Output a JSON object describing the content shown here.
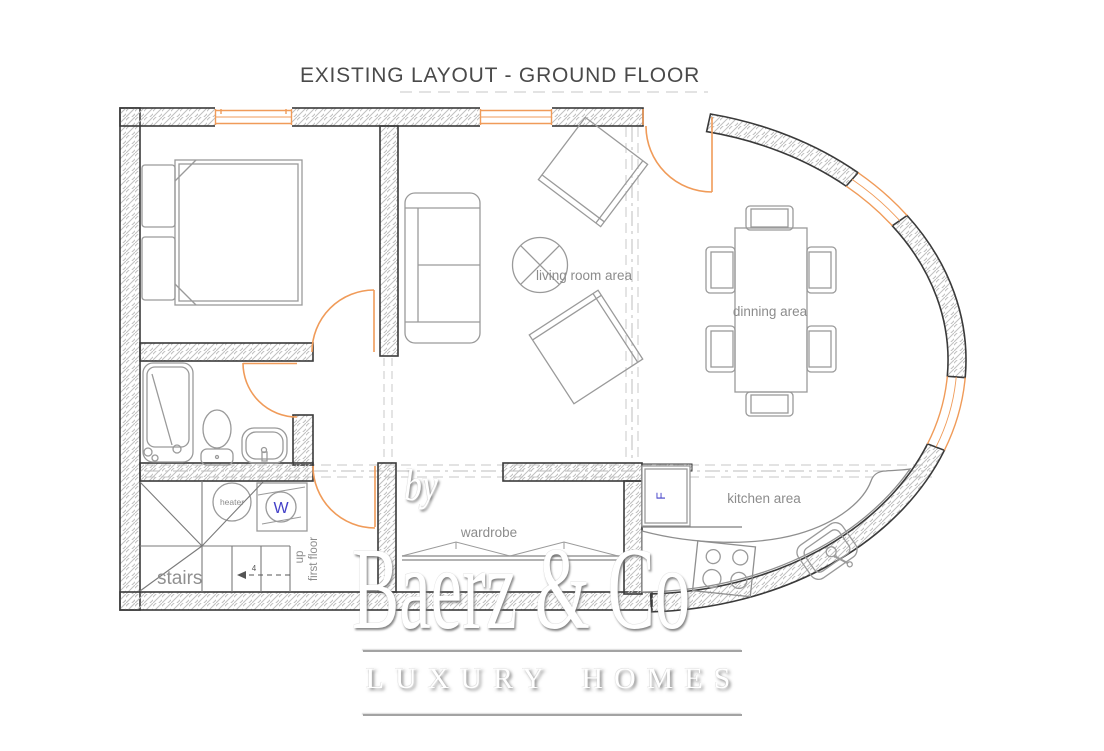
{
  "title": "EXISTING LAYOUT -  GROUND FLOOR",
  "plan": {
    "labels": {
      "living_room": "living room area",
      "dining": "dinning area",
      "kitchen": "kitchen area",
      "wardrobe": "wardrobe",
      "stairs": "stairs",
      "stairs_up": "up",
      "stairs_floor": "first floor",
      "stairs_steps": "4",
      "heater": "heater",
      "washing_machine": "W",
      "fridge": "F"
    },
    "colors": {
      "wall_outline": "#3a3a3a",
      "wall_hatch": "#c0c0c0",
      "furniture_line": "#9a9a9a",
      "door_window_orange": "#F09B59",
      "label_gray": "#8c8c8c",
      "appliance_blue": "#4340c8",
      "guide_dash_gray": "#d2d2d2"
    }
  },
  "watermark": {
    "prefix": "by",
    "brand": "Baerz & Co",
    "tagline": "LUXURY HOMES"
  }
}
